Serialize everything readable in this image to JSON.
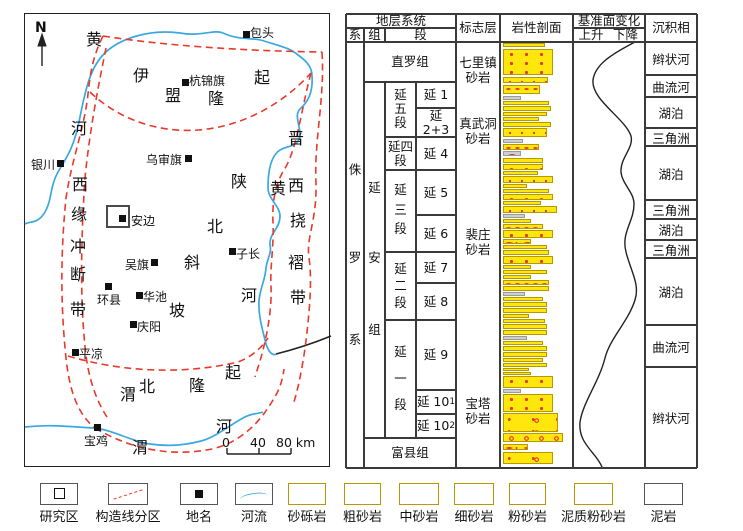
{
  "palette": {
    "yellow": "#ffe60d",
    "red": "#e8392a",
    "mud_gray": "#cfcfcf",
    "river_blue": "#3aa8e0",
    "line": "#3a3a3a"
  },
  "map": {
    "north_label": "N",
    "study_area_box": [
      106,
      205,
      24,
      23
    ],
    "scale_bar": {
      "labels": [
        {
          "t": "0",
          "x": 222
        },
        {
          "t": "40",
          "x": 250
        },
        {
          "t": "80 km",
          "x": 276
        }
      ],
      "y": 435
    },
    "cities": [
      {
        "name": "包头",
        "sq": [
          243,
          31
        ],
        "label": [
          250,
          24
        ]
      },
      {
        "name": "杭锦旗",
        "sq": [
          182,
          79
        ],
        "label": [
          189,
          72
        ]
      },
      {
        "name": "银川",
        "sq": [
          57,
          160
        ],
        "label": [
          31,
          156
        ]
      },
      {
        "name": "乌审旗",
        "sq": [
          185,
          155
        ],
        "label": [
          146,
          151
        ]
      },
      {
        "name": "安边",
        "sq": [
          119,
          215
        ],
        "label": [
          131,
          212
        ]
      },
      {
        "name": "子长",
        "sq": [
          229,
          248
        ],
        "label": [
          236,
          245
        ]
      },
      {
        "name": "吴旗",
        "sq": [
          151,
          259
        ],
        "label": [
          125,
          256
        ]
      },
      {
        "name": "环县",
        "sq": [
          105,
          283
        ],
        "label": [
          97,
          291
        ]
      },
      {
        "name": "华池",
        "sq": [
          136,
          292
        ],
        "label": [
          143,
          288
        ]
      },
      {
        "name": "庆阳",
        "sq": [
          130,
          321
        ],
        "label": [
          137,
          318
        ]
      },
      {
        "name": "平凉",
        "sq": [
          72,
          349
        ],
        "label": [
          79,
          345
        ]
      },
      {
        "name": "宝鸡",
        "sq": [
          94,
          424
        ],
        "label": [
          84,
          432
        ]
      }
    ],
    "region_chars": [
      {
        "c": "黄",
        "x": 85,
        "y": 31
      },
      {
        "c": "河",
        "x": 70,
        "y": 120
      },
      {
        "c": "伊",
        "x": 132,
        "y": 67
      },
      {
        "c": "盟",
        "x": 164,
        "y": 87
      },
      {
        "c": "隆",
        "x": 207,
        "y": 90
      },
      {
        "c": "起",
        "x": 253,
        "y": 69
      },
      {
        "c": "西",
        "x": 71,
        "y": 176
      },
      {
        "c": "缘",
        "x": 70,
        "y": 206
      },
      {
        "c": "冲",
        "x": 69,
        "y": 238
      },
      {
        "c": "断",
        "x": 69,
        "y": 266
      },
      {
        "c": "带",
        "x": 69,
        "y": 301
      },
      {
        "c": "陕",
        "x": 230,
        "y": 173
      },
      {
        "c": "北",
        "x": 206,
        "y": 218
      },
      {
        "c": "斜",
        "x": 183,
        "y": 254
      },
      {
        "c": "坡",
        "x": 168,
        "y": 302
      },
      {
        "c": "晋",
        "x": 287,
        "y": 130
      },
      {
        "c": "西",
        "x": 287,
        "y": 177
      },
      {
        "c": "挠",
        "x": 289,
        "y": 212
      },
      {
        "c": "褶",
        "x": 287,
        "y": 254
      },
      {
        "c": "带",
        "x": 289,
        "y": 289
      },
      {
        "c": "黄",
        "x": 269,
        "y": 180
      },
      {
        "c": "河",
        "x": 240,
        "y": 287
      },
      {
        "c": "渭",
        "x": 119,
        "y": 386
      },
      {
        "c": "北",
        "x": 138,
        "y": 378
      },
      {
        "c": "隆",
        "x": 188,
        "y": 377
      },
      {
        "c": "起",
        "x": 224,
        "y": 364
      },
      {
        "c": "渭",
        "x": 131,
        "y": 439
      },
      {
        "c": "河",
        "x": 215,
        "y": 418
      }
    ]
  },
  "strat": {
    "header_cells": [
      {
        "t": "地层系统",
        "x": 346,
        "y": 14,
        "w": 110,
        "h": 14
      },
      {
        "t": "系",
        "x": 346,
        "y": 28,
        "w": 18,
        "h": 14
      },
      {
        "t": "组",
        "x": 364,
        "y": 28,
        "w": 21,
        "h": 14
      },
      {
        "t": "段",
        "x": 385,
        "y": 28,
        "w": 71,
        "h": 14
      },
      {
        "t": "标志层",
        "x": 456,
        "y": 14,
        "w": 44,
        "h": 28
      },
      {
        "t": "岩性剖面",
        "x": 500,
        "y": 14,
        "w": 73,
        "h": 28
      },
      {
        "t": "基准面变化",
        "x": 573,
        "y": 14,
        "w": 72,
        "h": 14
      },
      {
        "t": "上升",
        "x": 574,
        "y": 28,
        "w": 34,
        "h": 14
      },
      {
        "t": "下降",
        "x": 607,
        "y": 28,
        "w": 37,
        "h": 14
      },
      {
        "t": "沉积相",
        "x": 645,
        "y": 14,
        "w": 52,
        "h": 28
      }
    ],
    "cells": [
      {
        "t": "直罗组",
        "x": 364,
        "y": 42,
        "w": 92,
        "h": 40
      },
      {
        "t": "富县组",
        "x": 364,
        "y": 438,
        "w": 92,
        "h": 30
      },
      {
        "t": "延四\n段",
        "x": 385,
        "y": 137,
        "w": 31,
        "h": 33
      },
      {
        "t": "延 1",
        "x": 416,
        "y": 82,
        "w": 40,
        "h": 26
      },
      {
        "t": "延 2+3",
        "x": 416,
        "y": 108,
        "w": 40,
        "h": 29
      },
      {
        "t": "延 4",
        "x": 416,
        "y": 137,
        "w": 40,
        "h": 33
      },
      {
        "t": "延 5",
        "x": 416,
        "y": 170,
        "w": 40,
        "h": 45
      },
      {
        "t": "延 6",
        "x": 416,
        "y": 215,
        "w": 40,
        "h": 37
      },
      {
        "t": "延 7",
        "x": 416,
        "y": 252,
        "w": 40,
        "h": 31
      },
      {
        "t": "延 8",
        "x": 416,
        "y": 283,
        "w": 40,
        "h": 37
      },
      {
        "t": "延 9",
        "x": 416,
        "y": 320,
        "w": 40,
        "h": 70
      },
      {
        "t": "延 10",
        "sub": "1",
        "x": 416,
        "y": 390,
        "w": 40,
        "h": 24
      },
      {
        "t": "延 10",
        "sub": "2",
        "x": 416,
        "y": 414,
        "w": 40,
        "h": 24
      }
    ],
    "vcells": [
      {
        "name": "jurassic-system",
        "chars": [
          "侏",
          "罗",
          "系"
        ],
        "x": 346,
        "w": 18,
        "cys": [
          170,
          258,
          340
        ]
      },
      {
        "name": "yanan-formation",
        "chars": [
          "延",
          "安",
          "组"
        ],
        "x": 364,
        "w": 21,
        "cys": [
          188,
          258,
          330
        ]
      },
      {
        "name": "member-yan5",
        "chars": [
          "延",
          "五",
          "段"
        ],
        "x": 385,
        "w": 31,
        "cys": [
          95,
          109,
          123
        ]
      },
      {
        "name": "member-yan3",
        "chars": [
          "延",
          "三",
          "段"
        ],
        "x": 385,
        "w": 31,
        "cys": [
          190,
          210,
          229
        ]
      },
      {
        "name": "member-yan2",
        "chars": [
          "延",
          "二",
          "段"
        ],
        "x": 385,
        "w": 31,
        "cys": [
          269,
          286,
          303
        ]
      },
      {
        "name": "member-yan1",
        "chars": [
          "延",
          "一",
          "段"
        ],
        "x": 385,
        "w": 31,
        "cys": [
          352,
          379,
          405
        ]
      }
    ],
    "markers": [
      {
        "t": "七里镇\n砂岩",
        "cx": 478,
        "cy": 70
      },
      {
        "t": "真武洞\n砂岩",
        "cx": 478,
        "cy": 131
      },
      {
        "t": "裴庄\n砂岩",
        "cx": 478,
        "cy": 242
      },
      {
        "t": "宝塔\n砂岩",
        "cx": 478,
        "cy": 411
      }
    ],
    "facies": [
      {
        "t": "辫状河",
        "y": 42,
        "h": 33
      },
      {
        "t": "曲流河",
        "y": 75,
        "h": 22
      },
      {
        "t": "湖泊",
        "y": 97,
        "h": 31
      },
      {
        "t": "三角洲",
        "y": 128,
        "h": 18
      },
      {
        "t": "湖泊",
        "y": 146,
        "h": 54
      },
      {
        "t": "三角洲",
        "y": 200,
        "h": 19
      },
      {
        "t": "湖泊",
        "y": 219,
        "h": 21
      },
      {
        "t": "三角洲",
        "y": 240,
        "h": 18
      },
      {
        "t": "湖泊",
        "y": 258,
        "h": 67
      },
      {
        "t": "曲流河",
        "y": 325,
        "h": 42
      },
      {
        "t": "辫状河",
        "y": 367,
        "h": 101
      }
    ],
    "litho": {
      "x": 503,
      "bars": [
        [
          43,
          4,
          42,
          "f"
        ],
        [
          49,
          26,
          50,
          "c"
        ],
        [
          77,
          6,
          45,
          "m"
        ],
        [
          85,
          9,
          37,
          "s"
        ],
        [
          96,
          4,
          18,
          "g"
        ],
        [
          101,
          4,
          46,
          "m"
        ],
        [
          106,
          5,
          48,
          "c"
        ],
        [
          112,
          4,
          44,
          "m"
        ],
        [
          117,
          4,
          36,
          "s"
        ],
        [
          122,
          5,
          48,
          "c"
        ],
        [
          128,
          9,
          44,
          "m"
        ],
        [
          139,
          4,
          20,
          "g"
        ],
        [
          144,
          6,
          36,
          "s"
        ],
        [
          151,
          5,
          18,
          "g"
        ],
        [
          158,
          5,
          40,
          "m"
        ],
        [
          164,
          6,
          40,
          "c"
        ],
        [
          171,
          4,
          35,
          "s"
        ],
        [
          176,
          7,
          50,
          "m"
        ],
        [
          184,
          4,
          24,
          "z"
        ],
        [
          189,
          4,
          46,
          "s"
        ],
        [
          194,
          6,
          50,
          "c"
        ],
        [
          201,
          4,
          38,
          "s"
        ],
        [
          206,
          7,
          54,
          "m"
        ],
        [
          214,
          4,
          22,
          "g"
        ],
        [
          219,
          4,
          28,
          "z"
        ],
        [
          224,
          5,
          40,
          "s"
        ],
        [
          230,
          8,
          50,
          "c"
        ],
        [
          239,
          5,
          28,
          "z"
        ],
        [
          245,
          4,
          44,
          "s"
        ],
        [
          250,
          5,
          46,
          "m"
        ],
        [
          256,
          8,
          50,
          "c"
        ],
        [
          265,
          4,
          28,
          "z"
        ],
        [
          270,
          4,
          44,
          "s"
        ],
        [
          275,
          4,
          28,
          "z"
        ],
        [
          280,
          5,
          46,
          "s"
        ],
        [
          286,
          5,
          46,
          "m"
        ],
        [
          292,
          4,
          22,
          "g"
        ],
        [
          297,
          4,
          40,
          "s"
        ],
        [
          302,
          5,
          44,
          "m"
        ],
        [
          308,
          5,
          44,
          "c"
        ],
        [
          314,
          4,
          26,
          "z"
        ],
        [
          319,
          4,
          42,
          "s"
        ],
        [
          324,
          5,
          44,
          "m"
        ],
        [
          330,
          5,
          44,
          "c"
        ],
        [
          336,
          4,
          24,
          "g"
        ],
        [
          341,
          4,
          40,
          "s"
        ],
        [
          346,
          5,
          44,
          "m"
        ],
        [
          352,
          5,
          44,
          "c"
        ],
        [
          358,
          4,
          40,
          "s"
        ],
        [
          363,
          4,
          44,
          "m"
        ],
        [
          368,
          3,
          26,
          "z"
        ],
        [
          372,
          3,
          28,
          "z"
        ],
        [
          376,
          12,
          50,
          "c"
        ],
        [
          389,
          4,
          18,
          "g"
        ],
        [
          394,
          18,
          50,
          "c"
        ],
        [
          413,
          19,
          55,
          "gl"
        ],
        [
          433,
          9,
          60,
          "gl2"
        ],
        [
          444,
          6,
          25,
          "z"
        ],
        [
          452,
          12,
          50,
          "gl"
        ]
      ]
    },
    "grid": {
      "v": [
        [
          346,
          14,
          468
        ],
        [
          364,
          28,
          468
        ],
        [
          385,
          28,
          42
        ],
        [
          385,
          82,
          438
        ],
        [
          416,
          82,
          438
        ],
        [
          456,
          14,
          468
        ],
        [
          500,
          14,
          468
        ],
        [
          573,
          14,
          468
        ],
        [
          645,
          14,
          468
        ],
        [
          697,
          14,
          468
        ]
      ],
      "h": [
        [
          14,
          346,
          697
        ],
        [
          28,
          346,
          456
        ],
        [
          28,
          573,
          645
        ],
        [
          42,
          346,
          697
        ],
        [
          468,
          346,
          697
        ],
        [
          82,
          364,
          456
        ],
        [
          108,
          416,
          456
        ],
        [
          137,
          385,
          456
        ],
        [
          170,
          385,
          456
        ],
        [
          215,
          416,
          456
        ],
        [
          252,
          385,
          456
        ],
        [
          283,
          416,
          456
        ],
        [
          320,
          385,
          456
        ],
        [
          390,
          416,
          456
        ],
        [
          414,
          416,
          456
        ],
        [
          438,
          364,
          456
        ],
        [
          75,
          645,
          697
        ],
        [
          97,
          645,
          697
        ],
        [
          128,
          645,
          697
        ],
        [
          146,
          645,
          697
        ],
        [
          200,
          645,
          697
        ],
        [
          219,
          645,
          697
        ],
        [
          240,
          645,
          697
        ],
        [
          258,
          645,
          697
        ],
        [
          325,
          645,
          697
        ],
        [
          367,
          645,
          697
        ]
      ]
    }
  },
  "legend": {
    "items": [
      {
        "label": "研究区",
        "type": "study",
        "x": 40,
        "w": 38
      },
      {
        "label": "构造线分区",
        "type": "tectonic",
        "x": 108,
        "w": 40
      },
      {
        "label": "地名",
        "type": "place",
        "x": 180,
        "w": 38
      },
      {
        "label": "河流",
        "type": "river",
        "x": 235,
        "w": 38
      },
      {
        "label": "砂砾岩",
        "type": "gl",
        "x": 288,
        "w": 38
      },
      {
        "label": "粗砂岩",
        "type": "c",
        "x": 344,
        "w": 37
      },
      {
        "label": "中砂岩",
        "type": "m",
        "x": 399,
        "w": 40
      },
      {
        "label": "细砂岩",
        "type": "f",
        "x": 454,
        "w": 40
      },
      {
        "label": "粉砂岩",
        "type": "s",
        "x": 509,
        "w": 37
      },
      {
        "label": "泥质粉砂岩",
        "type": "z",
        "x": 574,
        "w": 39
      },
      {
        "label": "泥岩",
        "type": "g",
        "x": 644,
        "w": 39
      }
    ],
    "box_y": 483,
    "label_y": 506
  }
}
